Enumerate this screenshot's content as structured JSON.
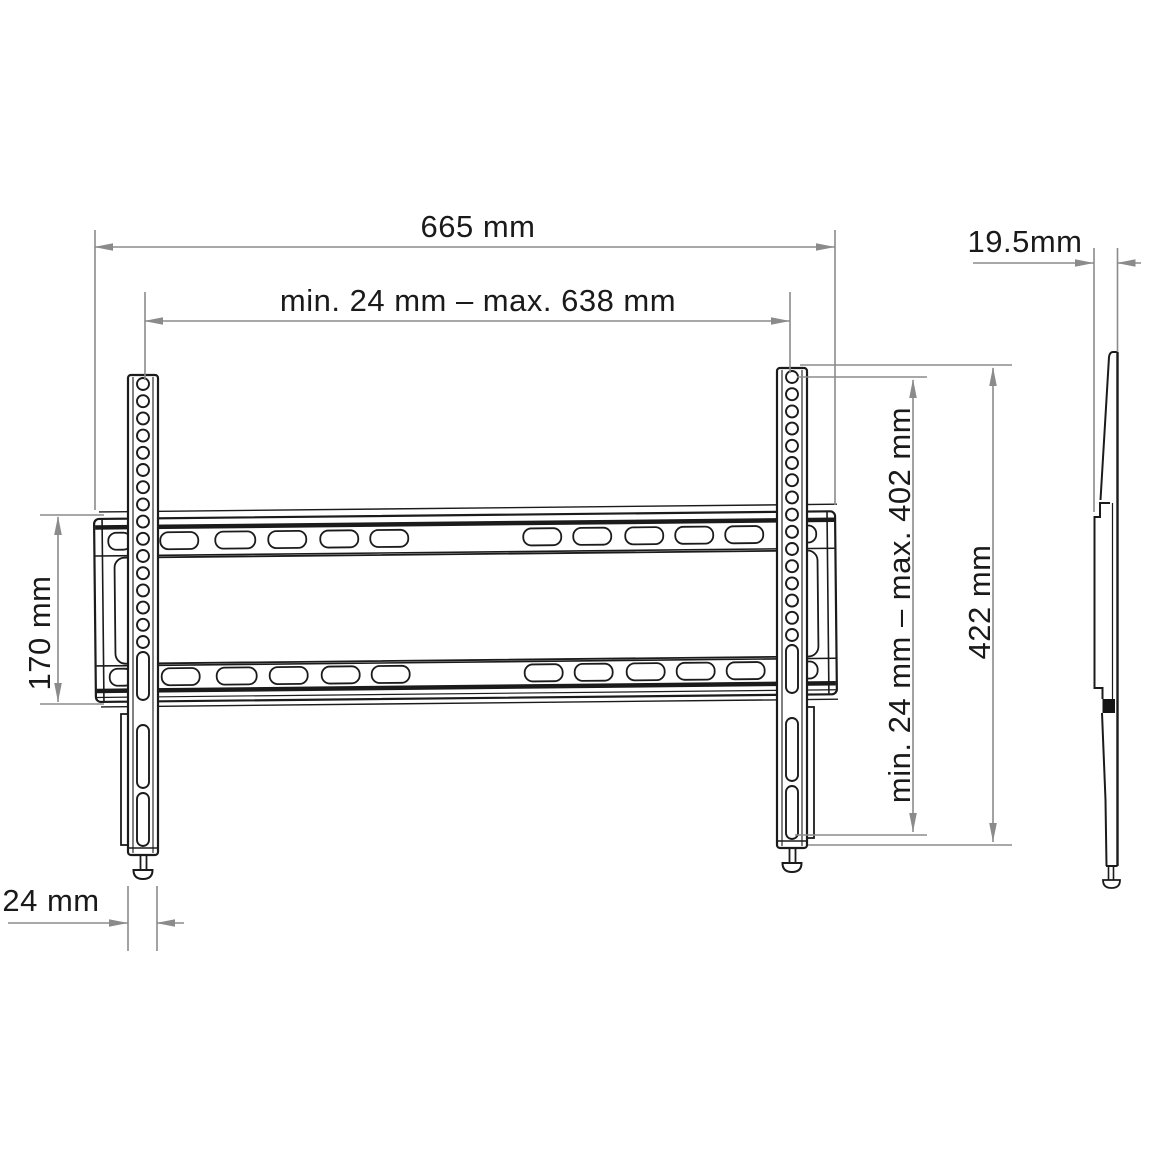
{
  "diagram": {
    "subject": "TV wall mount bracket technical drawing",
    "views": {
      "front": "front view with wall plate and two vertical TV rails",
      "side": "side profile view"
    },
    "colors": {
      "background": "#ffffff",
      "line": "#1b1b1b",
      "dimension": "#8b8b8b",
      "text": "#1a1a1a"
    },
    "dimensions": [
      {
        "id": "total-width",
        "label": "665 mm",
        "orientation": "horizontal"
      },
      {
        "id": "rail-spacing-range",
        "label": "min. 24 mm – max. 638 mm",
        "orientation": "horizontal"
      },
      {
        "id": "plate-height",
        "label": "170 mm",
        "orientation": "vertical"
      },
      {
        "id": "vertical-hole-range",
        "label": "min. 24 mm – max. 402 mm",
        "orientation": "vertical"
      },
      {
        "id": "rail-height",
        "label": "422 mm",
        "orientation": "vertical"
      },
      {
        "id": "rail-width",
        "label": "24 mm",
        "orientation": "horizontal"
      },
      {
        "id": "depth",
        "label": "19.5mm",
        "orientation": "horizontal"
      }
    ]
  }
}
